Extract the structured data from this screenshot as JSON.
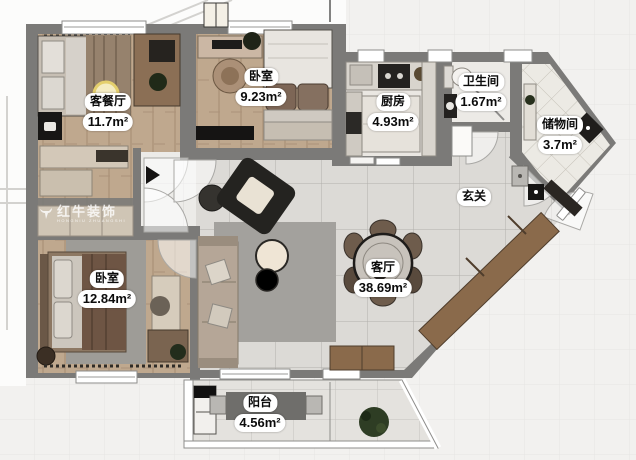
{
  "plan": {
    "title": "户型平面图",
    "rooms": [
      {
        "id": "living-dining",
        "name": "客餐厅",
        "area": "11.7m²"
      },
      {
        "id": "bedroom-top",
        "name": "卧室",
        "area": "9.23m²"
      },
      {
        "id": "kitchen",
        "name": "厨房",
        "area": "4.93m²"
      },
      {
        "id": "bathroom",
        "name": "卫生间",
        "area": "1.67m²"
      },
      {
        "id": "storage",
        "name": "储物间",
        "area": "3.7m²"
      },
      {
        "id": "foyer",
        "name": "玄关",
        "area": ""
      },
      {
        "id": "bedroom-bottom",
        "name": "卧室",
        "area": "12.84m²"
      },
      {
        "id": "living-room",
        "name": "客厅",
        "area": "38.69m²"
      },
      {
        "id": "balcony",
        "name": "阳台",
        "area": "4.56m²"
      }
    ],
    "watermark": {
      "brand": "红牛装饰",
      "subtext": "HONGNIU ZHUANGSHI"
    },
    "colors": {
      "wall": "#7b7a78",
      "wood_floor": "#bfa88e",
      "tile_floor": "#dcdad6",
      "cabinet_beige": "#cfc5b5",
      "sideboard_wood": "#8a6a4b",
      "rug_gray": "#a3a19d",
      "dark_furniture": "#1e1d1b"
    }
  }
}
